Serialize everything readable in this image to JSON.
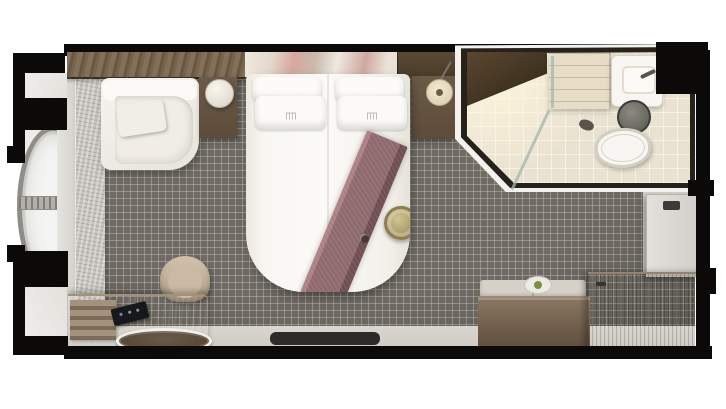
{
  "scene": {
    "description": "Top-down 3D rendered floor plan of a cruise-ship ocean-view stateroom on a white background",
    "width_px": 726,
    "height_px": 409,
    "background": "#ffffff"
  },
  "palette": {
    "wall_black": "#0b0a09",
    "hull_light": "#e3e1dc",
    "stone_wall": "#c7c4be",
    "recess": "#edebe7",
    "window_ring": "#8f8d87",
    "window_glass": "#f4f4f2",
    "mullion": "#b2b0aa",
    "carpet_base": "#6f6b64",
    "floor_light": "#d9d6cf",
    "entry_floor": "#d5d1c9",
    "door_panel": "#d2d0ca",
    "art_pink": "#d6a79f",
    "panel_wood": "#4a3c2a",
    "nightstand_wood": "#5d4c3b",
    "pendant": "#d6c9a8",
    "sofa_white": "#f6f4ef",
    "coral": "#b86f47",
    "bed_white": "#f8f7f3",
    "pillow": "#fcfbf8",
    "runner_main": "#8d686c",
    "runner_light": "#ad7f83",
    "runner_dark": "#6f4c50",
    "plate_gold": "#a6955f",
    "plate_ring": "#8e7d50",
    "bath_wall": "#f4f2ee",
    "bath_dark": "#262119",
    "bath_floor": "#eae2d0",
    "shelf_dark": "#2f2517",
    "vanity": "#e7ddc6",
    "fixture_white": "#f7f6f2",
    "toilet_tank": "#57574f",
    "glass": "rgba(165,180,175,0.75)",
    "bench_cushion": "#d7d2c8",
    "bench_wood": "#5f4e3d",
    "wardrobe_wood": "#6e5c4a",
    "desk_wood": "#8a7866",
    "tray_wood": "#a4927c",
    "tablet": "#17181c",
    "oval_rim": "#f2f0ea",
    "oval_fill": "#51432f",
    "chair_fill": "#b19f88",
    "chair_inner": "#cbbaa3",
    "mat_dark": "#2c2b29"
  },
  "rooms": [
    {
      "name": "bedroom",
      "floor": "grey mosaic carpet",
      "items": [
        "corner-sofa",
        "coral-throw-pillow",
        "left-nightstand",
        "table-lamp",
        "queen-bed",
        "bed-pillows",
        "bed-runner",
        "decorative-plate",
        "right-nightstand",
        "pendant-lamp",
        "wall-artwork",
        "wood-trim",
        "desk",
        "desk-chair",
        "tablet",
        "drawer-trays",
        "round-tray",
        "floor-mat",
        "bench-sofa",
        "decor-bowl",
        "wardrobe-cabinet"
      ]
    },
    {
      "name": "bathroom",
      "floor": "beige tile",
      "items": [
        "shower",
        "glass-partition",
        "corner-shelf",
        "vanity-shelves",
        "sink",
        "faucet",
        "toilet-bowl",
        "toilet-tank",
        "waste-bin"
      ]
    },
    {
      "name": "entry",
      "items": [
        "entry-door",
        "door-handle",
        "entry-floor"
      ]
    },
    {
      "name": "exterior",
      "items": [
        "porthole-window",
        "window-mullion",
        "window-pillar",
        "stone-accent-wall",
        "ship-hull-sections"
      ]
    }
  ],
  "counts": {
    "bed_pillows": 4,
    "portholes": 1
  }
}
